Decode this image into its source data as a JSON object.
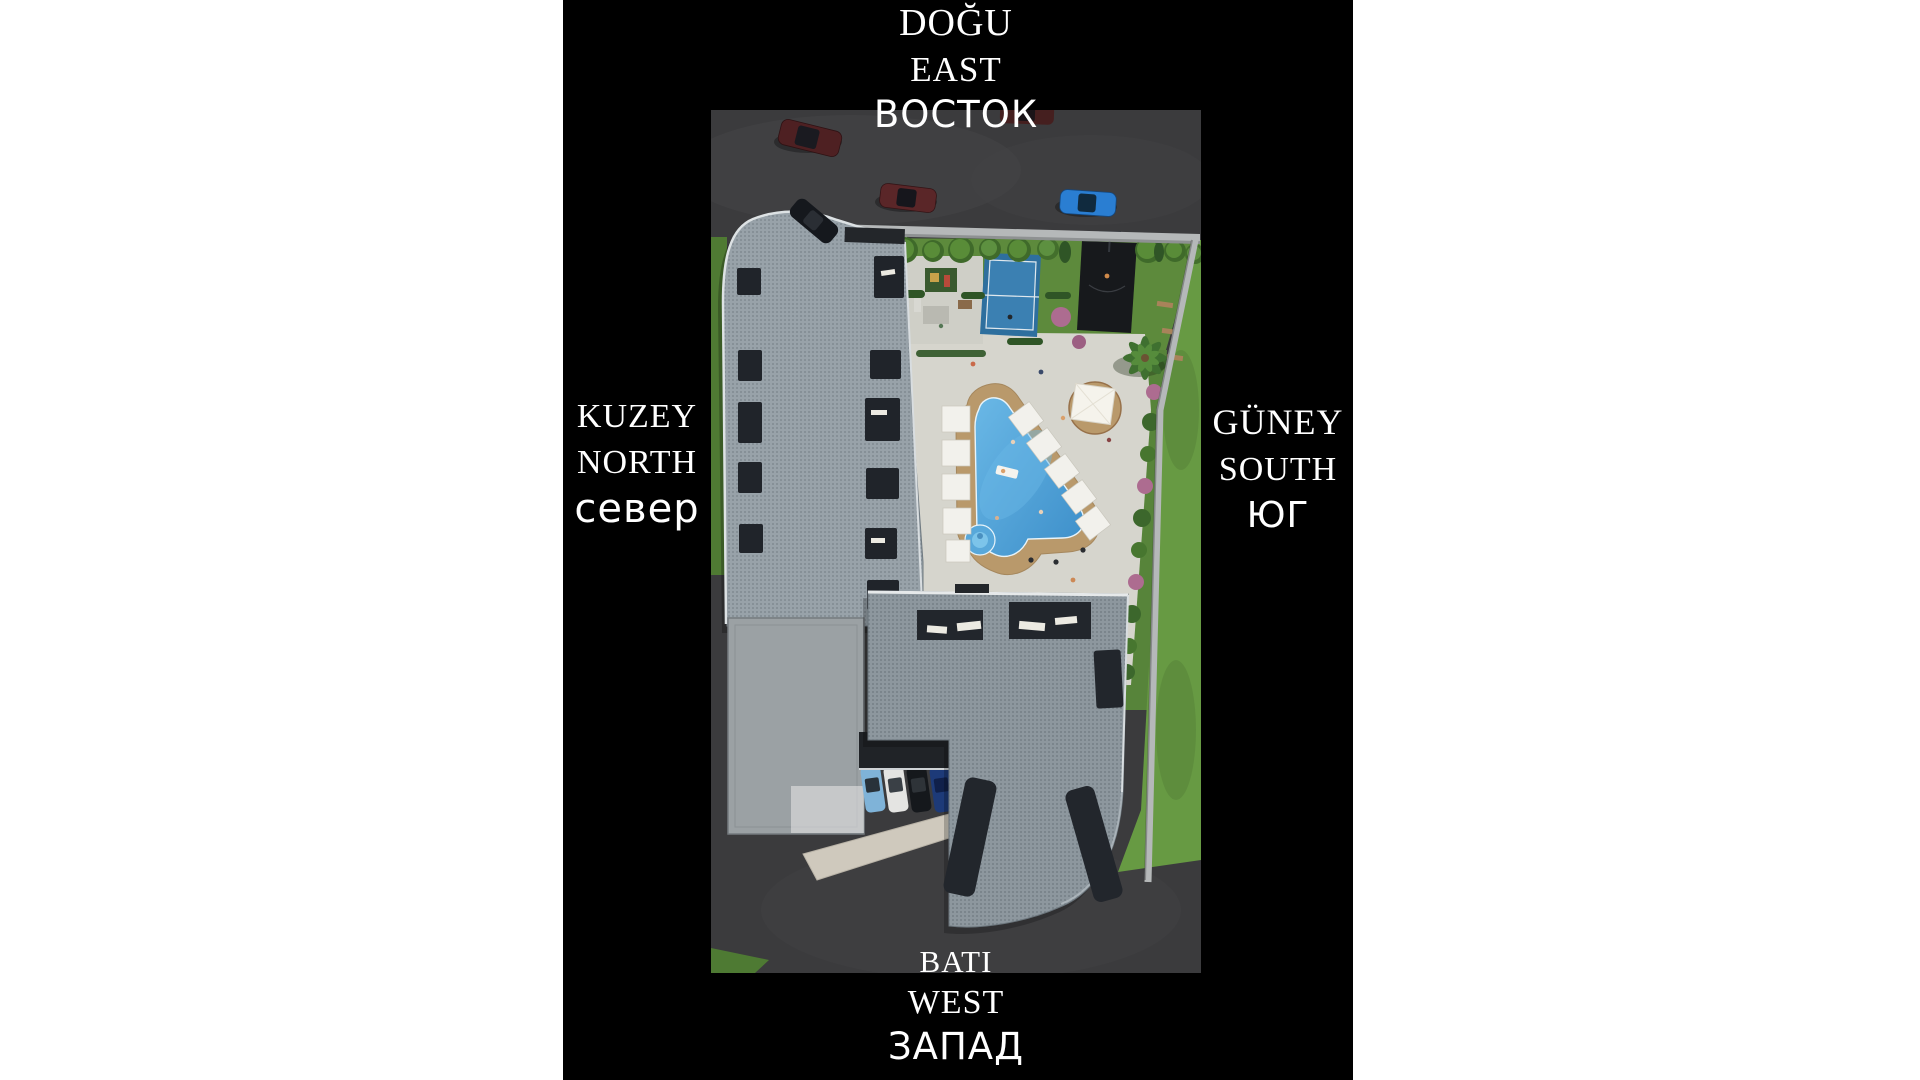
{
  "page": {
    "background": "#ffffff",
    "panel_background": "#000000",
    "label_text_color": "#ffffff"
  },
  "compass_labels": {
    "east": {
      "turkish": "DOĞU",
      "english": "EAST",
      "russian": "ВОСТОК"
    },
    "north": {
      "turkish": "KUZEY",
      "english": "NORTH",
      "russian": "север"
    },
    "south": {
      "turkish": "GÜNEY",
      "english": "SOUTH",
      "russian": "ЮГ"
    },
    "west": {
      "turkish": "BATI",
      "english": "WEST",
      "russian": "ЗАПАД"
    }
  },
  "site_plan": {
    "objects": [
      "asphalt-road",
      "boundary-wall",
      "lawn",
      "tree-row",
      "hedge",
      "shrub-row",
      "flower-bushes",
      "benches",
      "tennis-court",
      "basketball-court",
      "playground",
      "entrance-walkway",
      "palm-tree",
      "gazebo",
      "pool-terrace",
      "swimming-pool",
      "jacuzzi",
      "pool-float",
      "sun-loungers",
      "north-building",
      "flat-roof-annex",
      "west-building",
      "parking-canopy",
      "driveway",
      "people"
    ],
    "road_cars": [
      "dark-red-car-top-edge",
      "dark-red-suv",
      "dark-red-sedan",
      "blue-sedan",
      "black-car"
    ],
    "parking_cars": [
      "light-blue-car",
      "white-car",
      "black-car",
      "navy-car"
    ],
    "colors": {
      "asphalt": "#3b3b3d",
      "asphalt_light": "#47474a",
      "grass": "#5d8a3c",
      "grass_dark": "#4f7a33",
      "grass_outer": "#679a43",
      "wall": "#b5b8b9",
      "pavement": "#d6d5cd",
      "playground_paving": "#cfcfc7",
      "deck_wood": "#b9996b",
      "pool_water": "#3f93cf",
      "pool_water_light": "#6ab8e6",
      "court_blue": "#2e6f9e",
      "court_black": "#17191c",
      "roof_flat": "#9ba1a4",
      "window_dark": "#20242a",
      "lounger": "#f2f1ec",
      "tree_green": "#44702c",
      "hedge_green": "#2f5526",
      "flower_pink": "#ad6c90",
      "gazebo_roof": "#f5f3ec"
    }
  }
}
